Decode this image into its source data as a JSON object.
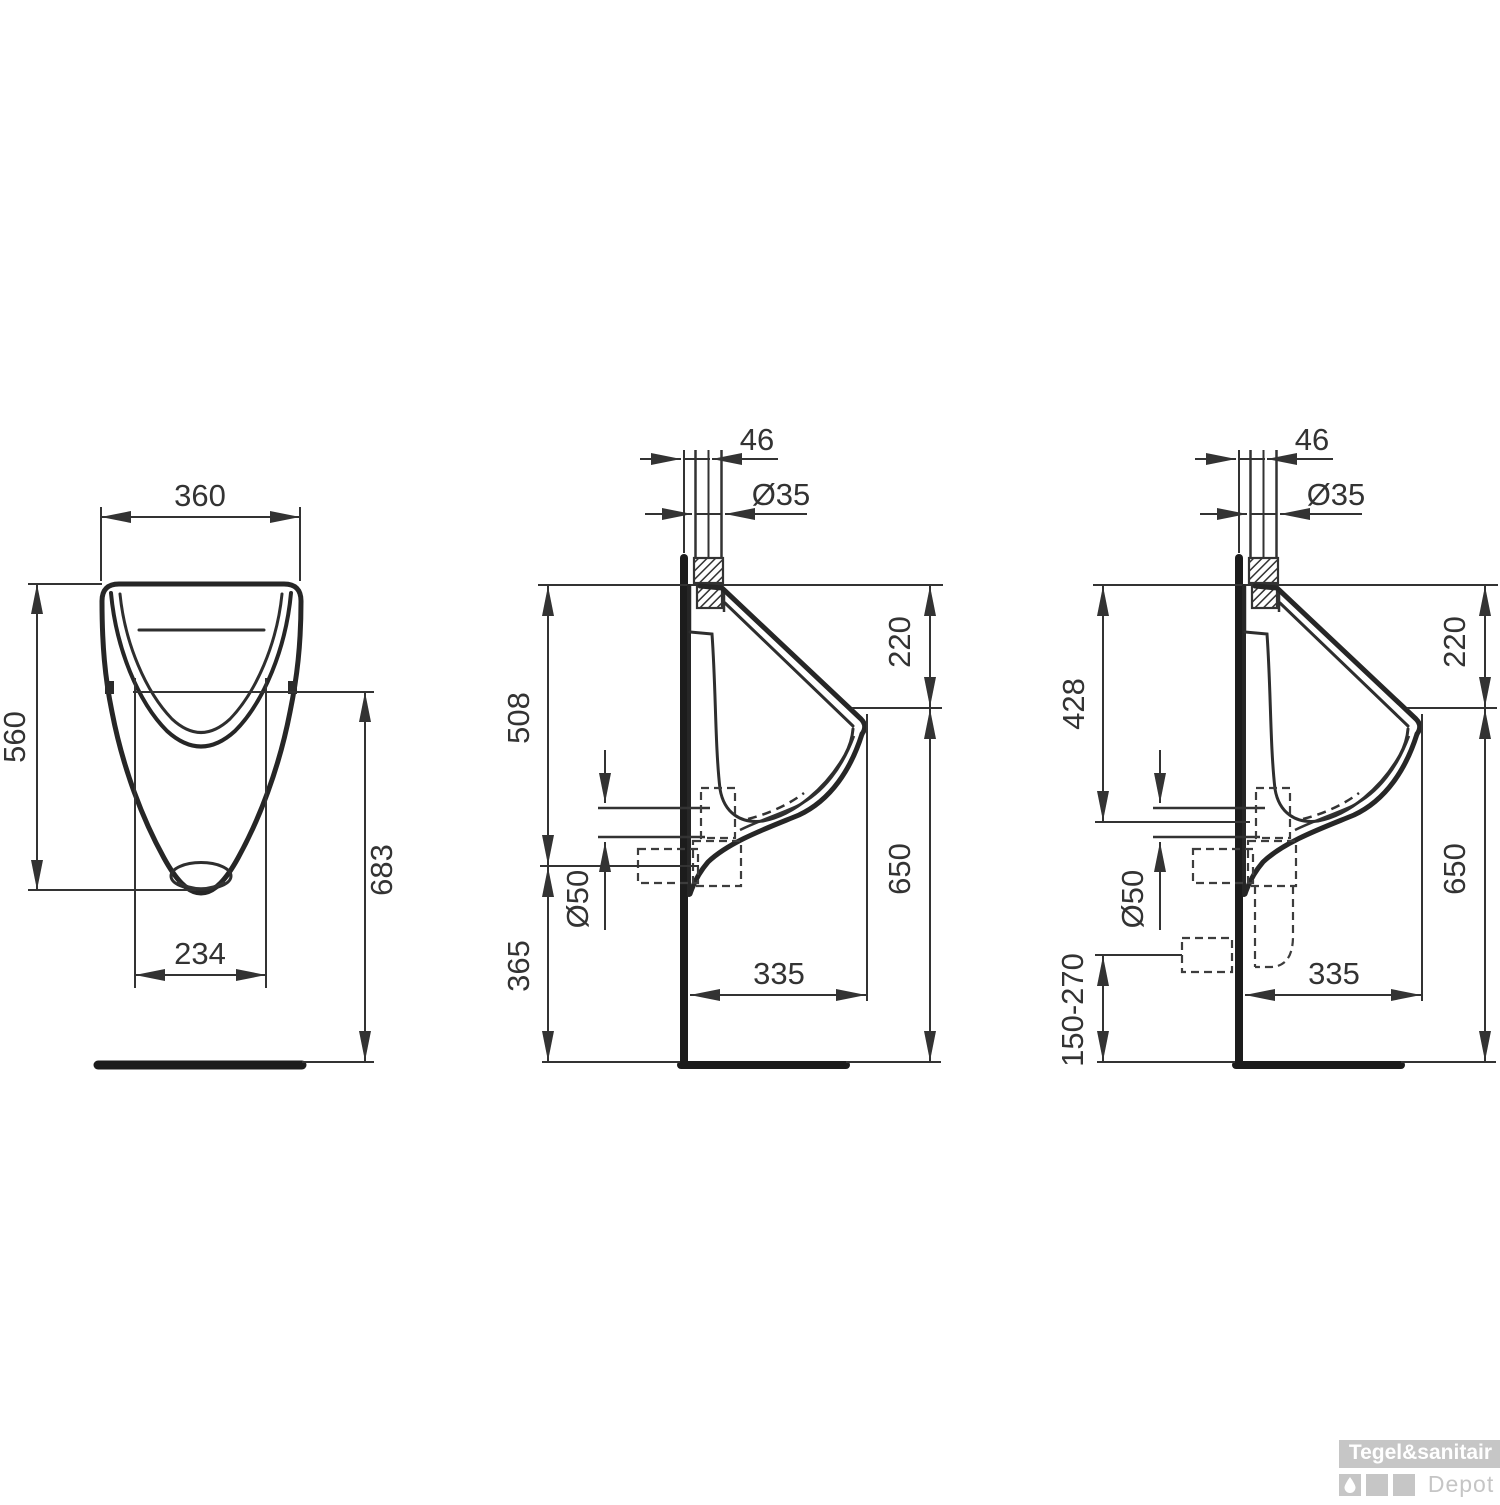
{
  "dims": {
    "front": {
      "overall_width": "360",
      "overall_height": "560",
      "rim_to_floor": "683",
      "bowl_width": "234"
    },
    "side_wall": {
      "inlet_offset": "46",
      "inlet_dia": "Ø35",
      "top_to_spout": "220",
      "top_to_outlet": "508",
      "outlet_dia": "Ø50",
      "spout_to_floor": "650",
      "outlet_to_floor": "365",
      "depth": "335"
    },
    "side_floor": {
      "inlet_offset": "46",
      "inlet_dia": "Ø35",
      "top_to_spout": "220",
      "top_to_outlet": "428",
      "outlet_dia": "Ø50",
      "spout_to_floor": "650",
      "outlet_height_range": "150-270",
      "depth": "335"
    }
  },
  "watermark": {
    "brand": "Tegel&sanitair",
    "sub": "Depot"
  },
  "colors": {
    "line": "#333333",
    "thick_line": "#1c1c1c",
    "watermark_gray": "#c6c6c6"
  }
}
